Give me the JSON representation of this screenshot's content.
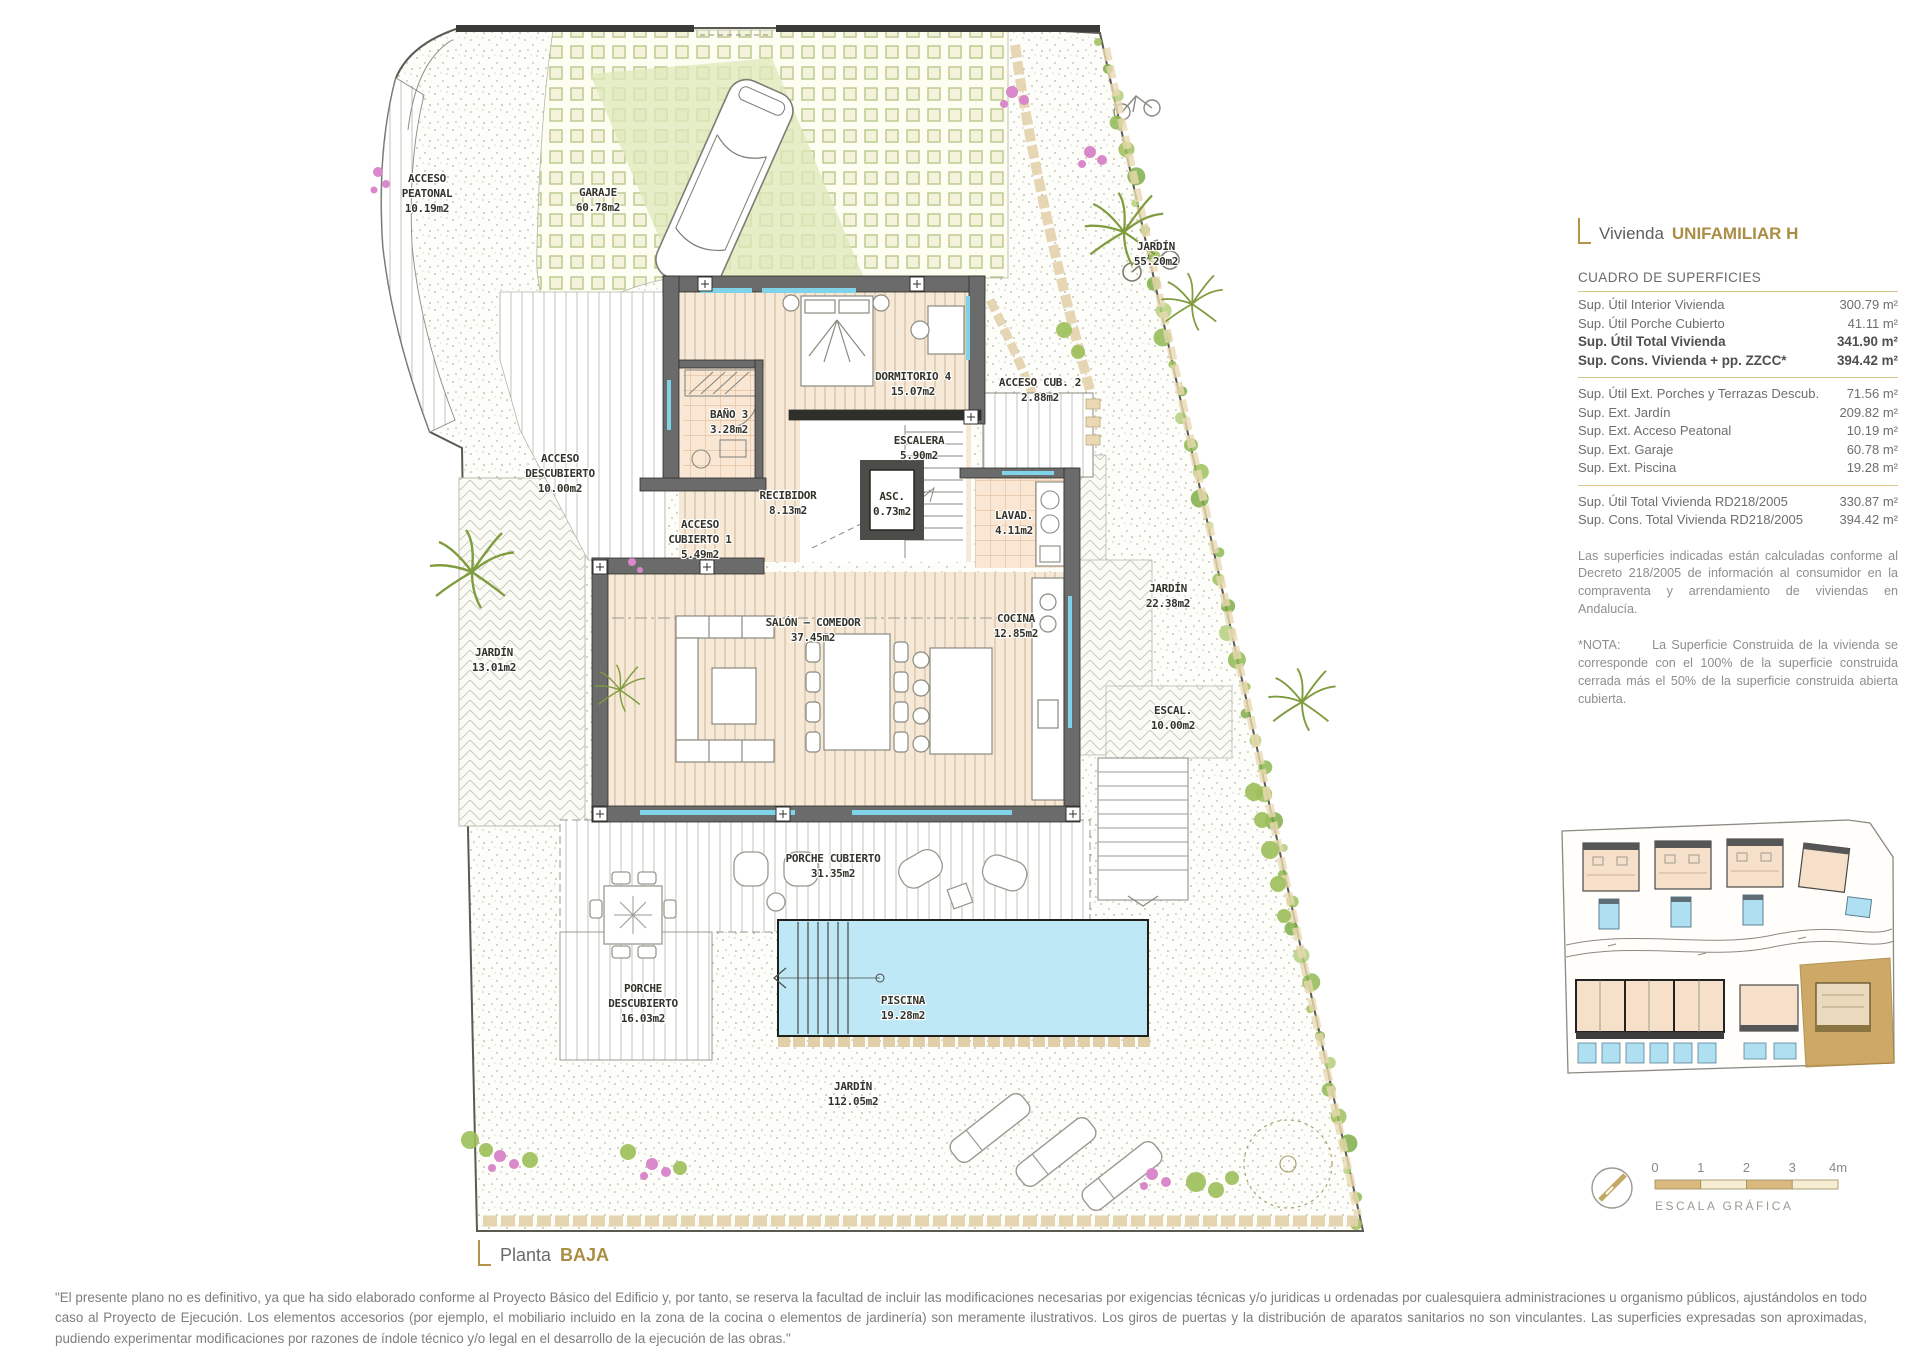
{
  "title": {
    "prefix": "Vivienda",
    "highlight": "UNIFAMILIAR H"
  },
  "panel": {
    "heading": "CUADRO DE SUPERFICIES",
    "groups": [
      {
        "rows": [
          {
            "label": "Sup. Útil Interior Vivienda",
            "value": "300.79 m²",
            "bold": false
          },
          {
            "label": "Sup. Útil Porche Cubierto",
            "value": "41.11 m²",
            "bold": false
          },
          {
            "label": "Sup. Útil Total Vivienda",
            "value": "341.90 m²",
            "bold": true
          },
          {
            "label": "Sup. Cons. Vivienda + pp. ZZCC*",
            "value": "394.42 m²",
            "bold": true
          }
        ]
      },
      {
        "rows": [
          {
            "label": "Sup. Útil Ext. Porches y Terrazas Descub.",
            "value": "71.56 m²",
            "bold": false
          },
          {
            "label": "Sup. Ext. Jardín",
            "value": "209.82 m²",
            "bold": false
          },
          {
            "label": "Sup. Ext. Acceso Peatonal",
            "value": "10.19 m²",
            "bold": false
          },
          {
            "label": "Sup. Ext. Garaje",
            "value": "60.78 m²",
            "bold": false
          },
          {
            "label": "Sup. Ext. Piscina",
            "value": "19.28 m²",
            "bold": false
          }
        ]
      },
      {
        "rows": [
          {
            "label": "Sup. Útil Total Vivienda RD218/2005",
            "value": "330.87 m²",
            "bold": false
          },
          {
            "label": "Sup. Cons. Total Vivienda RD218/2005",
            "value": "394.42 m²",
            "bold": false
          }
        ]
      }
    ],
    "note1": "Las superficies indicadas están calculadas conforme al Decreto 218/2005 de información al consumidor en la compraventa y arrendamiento de viviendas en Andalucía.",
    "note2": "*NOTA:      La Superficie Construida de la vivienda se corresponde con el 100% de la superficie construida cerrada más el 50% de la superficie construida abierta cubierta."
  },
  "plan": {
    "rooms": [
      {
        "id": "acceso-peatonal",
        "lines": [
          "ACCESO",
          "PEATONAL",
          "10.19m2"
        ]
      },
      {
        "id": "garaje",
        "lines": [
          "GARAJE",
          "60.78m2"
        ]
      },
      {
        "id": "jardin-norte",
        "lines": [
          "JARDÍN",
          "55.20m2"
        ]
      },
      {
        "id": "dormitorio-4",
        "lines": [
          "DORMITORIO 4",
          "15.07m2"
        ]
      },
      {
        "id": "acceso-cub-2",
        "lines": [
          "ACCESO CUB. 2",
          "2.88m2"
        ]
      },
      {
        "id": "bano-3",
        "lines": [
          "BAÑO 3",
          "3.28m2"
        ]
      },
      {
        "id": "escalera",
        "lines": [
          "ESCALERA",
          "5.90m2"
        ]
      },
      {
        "id": "recibidor",
        "lines": [
          "RECIBIDOR",
          "8.13m2"
        ]
      },
      {
        "id": "ascensor",
        "lines": [
          "ASC.",
          "0.73m2"
        ]
      },
      {
        "id": "lavadero",
        "lines": [
          "LAVAD.",
          "4.11m2"
        ]
      },
      {
        "id": "acceso-descubierto",
        "lines": [
          "ACCESO",
          "DESCUBIERTO",
          "10.00m2"
        ]
      },
      {
        "id": "acceso-cubierto-1",
        "lines": [
          "ACCESO",
          "CUBIERTO 1",
          "5.49m2"
        ]
      },
      {
        "id": "jardin-oeste",
        "lines": [
          "JARDÍN",
          "13.01m2"
        ]
      },
      {
        "id": "salon-comedor",
        "lines": [
          "SALÓN – COMEDOR",
          "37.45m2"
        ]
      },
      {
        "id": "cocina",
        "lines": [
          "COCINA",
          "12.85m2"
        ]
      },
      {
        "id": "jardin-este",
        "lines": [
          "JARDÍN",
          "22.38m2"
        ]
      },
      {
        "id": "escal-exterior",
        "lines": [
          "ESCAL.",
          "10.00m2"
        ]
      },
      {
        "id": "porche-cubierto",
        "lines": [
          "PORCHE CUBIERTO",
          "31.35m2"
        ]
      },
      {
        "id": "porche-descubierto",
        "lines": [
          "PORCHE",
          "DESCUBIERTO",
          "16.03m2"
        ]
      },
      {
        "id": "piscina",
        "lines": [
          "PISCINA",
          "19.28m2"
        ]
      },
      {
        "id": "jardin-sur",
        "lines": [
          "JARDÍN",
          "112.05m2"
        ]
      }
    ]
  },
  "scale_bar": {
    "ticks": [
      "0",
      "1",
      "2",
      "3",
      "4m"
    ],
    "label": "ESCALA GRÁFICA"
  },
  "footer": {
    "floor_prefix": "Planta",
    "floor_highlight": "BAJA",
    "disclaimer": "\"El presente plano no es definitivo, ya que ha sido elaborado conforme al Proyecto Básico del Edificio y, por tanto, se reserva la facultad de incluir las modificaciones necesarias por exigencias técnicas y/o juridicas u ordenadas por cualesquiera administraciones u organismo públicos, ajustándolos en todo caso al Proyecto de Ejecución. Los elementos accesorios (por ejemplo, el mobiliario incluido en la zona de la cocina o elementos de jardinería) son meramente ilustrativos. Los giros de puertas y la distribución de aparatos sanitarios no son vinculantes. Las superficies expresadas son aproximadas, pudiendo experimentar modificaciones por razones de índole técnico y/o legal en el desarrollo de la ejecución de las obras.\""
  },
  "colors": {
    "accent_gold": "#ab8e45",
    "rule_tan": "#d8c48f",
    "pool_blue": "#bfe8f7",
    "wall_gray": "#6b6b6b",
    "wood_floor": "#f7e9d8",
    "parcel_highlight": "#c59a4d",
    "hedge_green": "#9dc05a",
    "window_cyan": "#7ed3e8"
  }
}
